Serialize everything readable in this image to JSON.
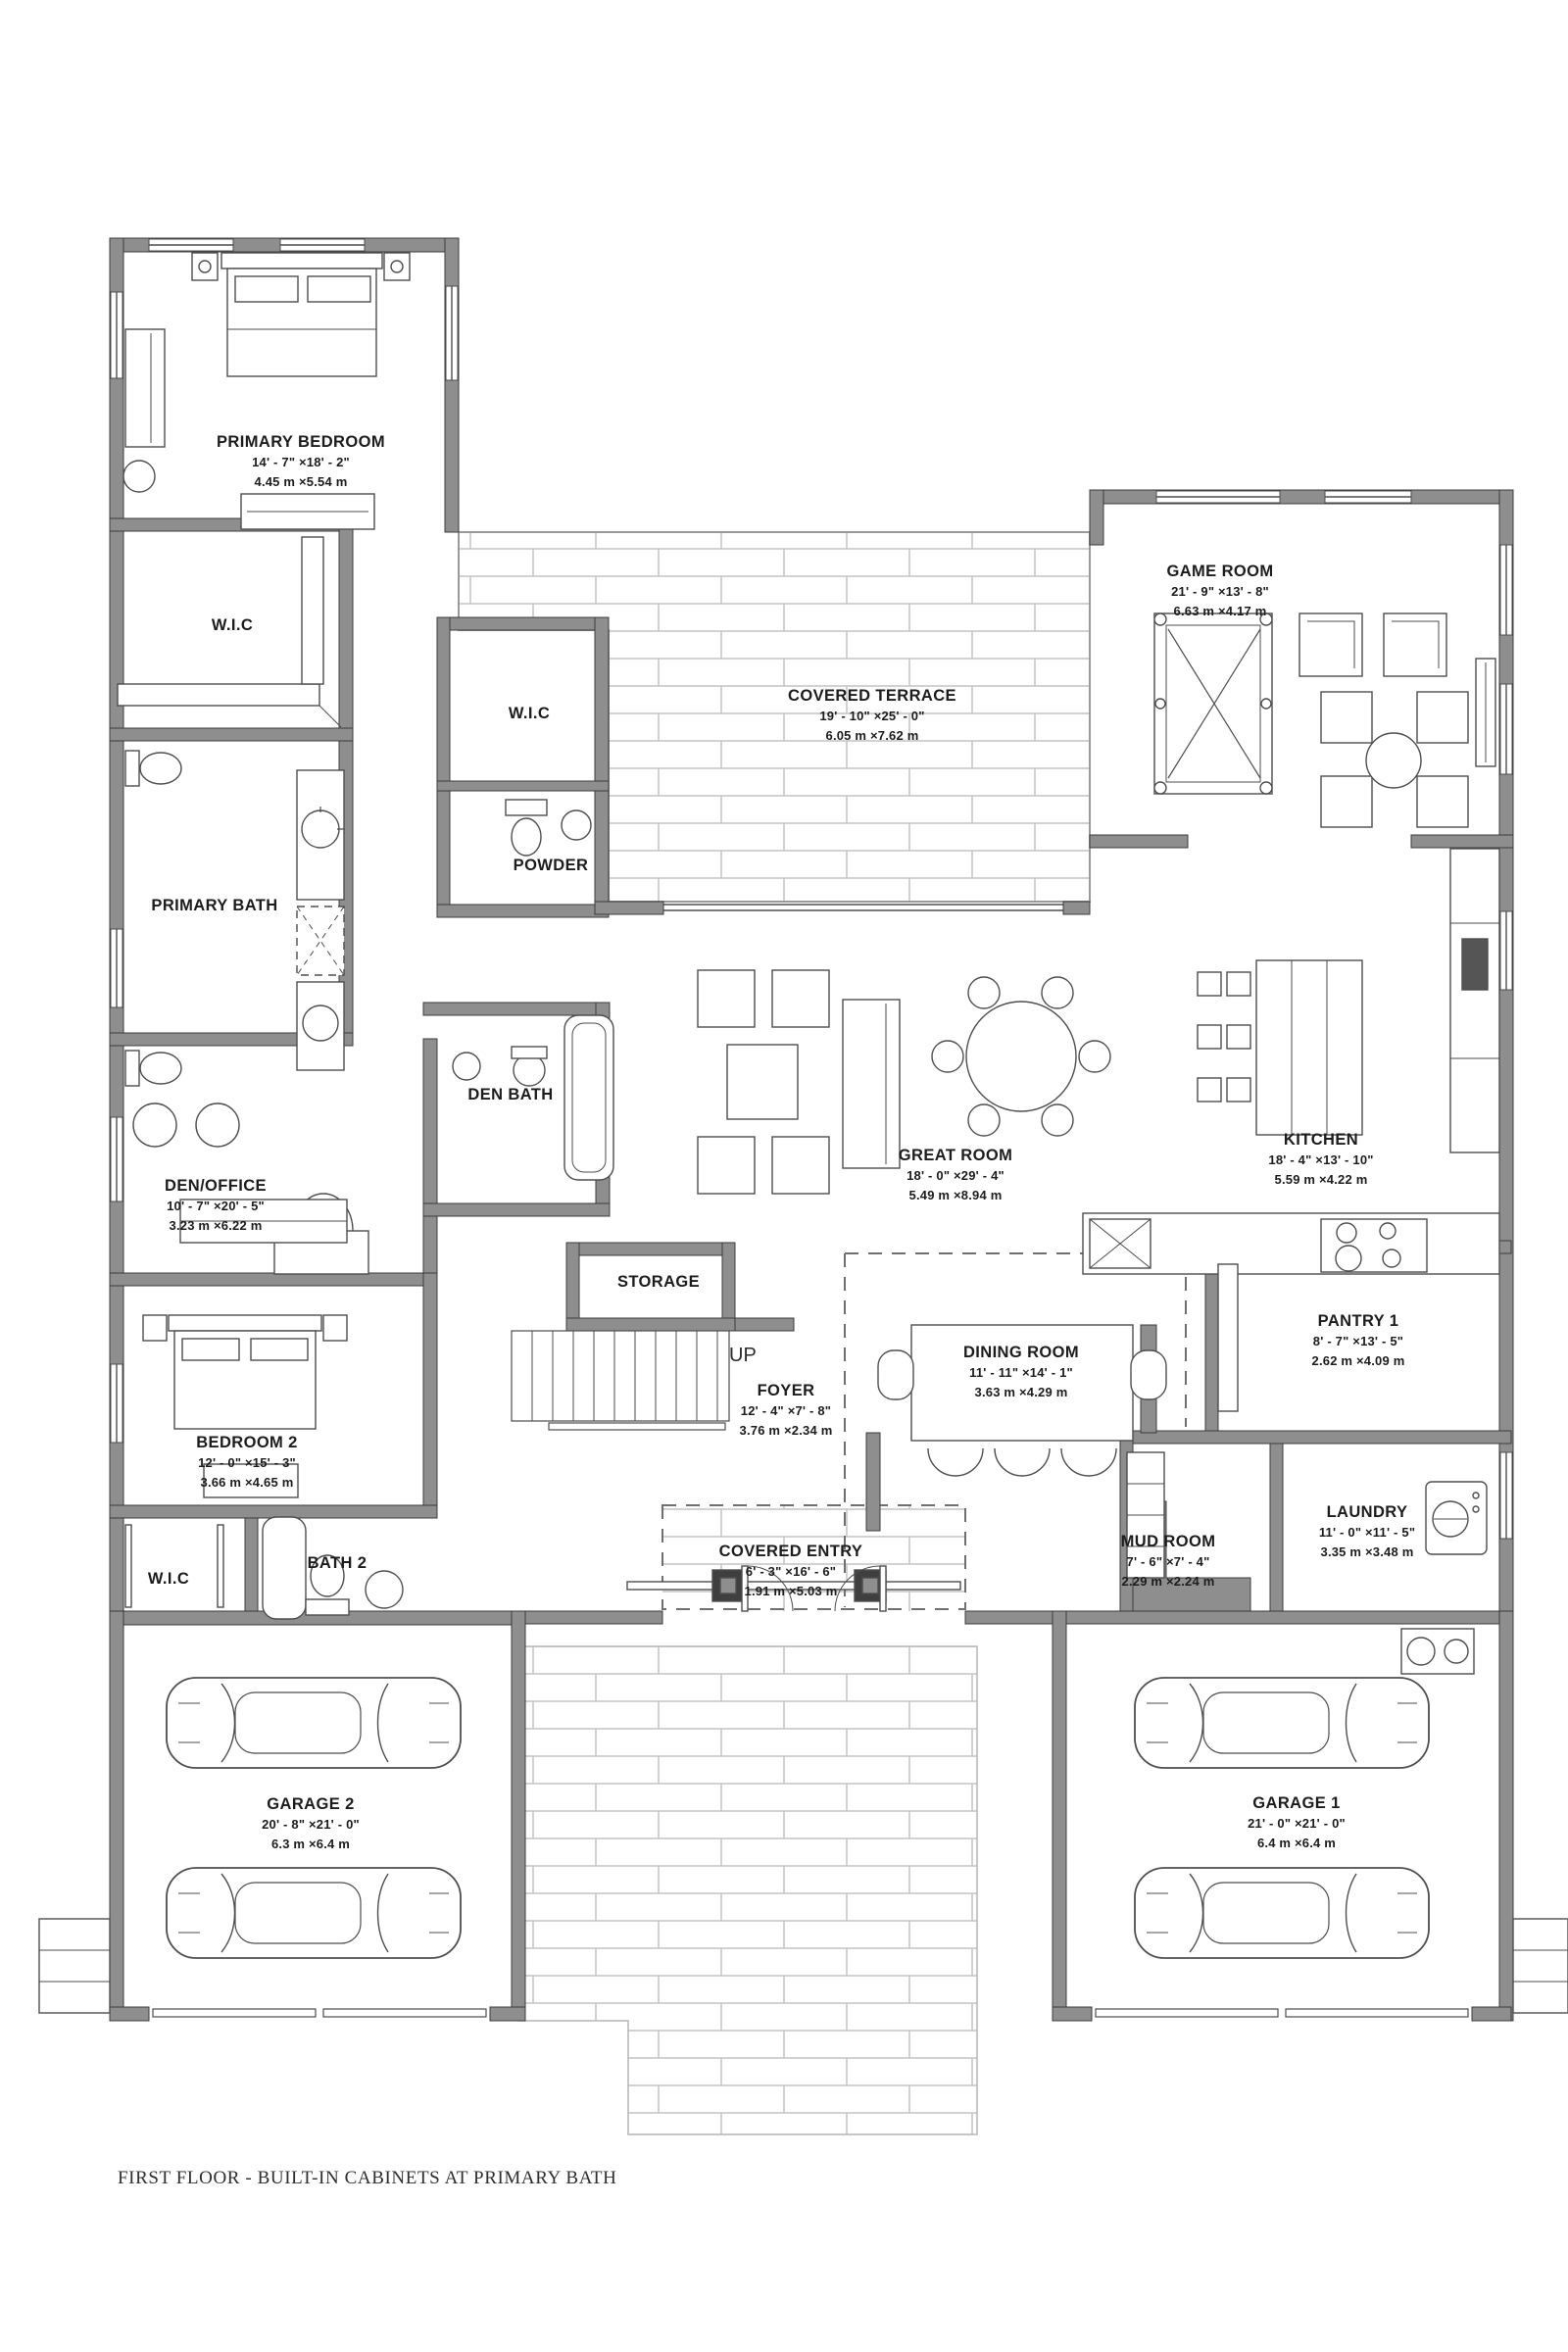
{
  "page": {
    "footer": "FIRST FLOOR - BUILT-IN CABINETS AT PRIMARY BATH"
  },
  "colors": {
    "wall": "#8e8e8e",
    "outline": "#3c3c3c",
    "furniture_line": "#4e4e4e",
    "brick_line": "#c4c4c4",
    "text": "#1c1c1c"
  },
  "stairs": {
    "direction_label": "UP"
  },
  "rooms": [
    {
      "id": "primary-bedroom",
      "name": "PRIMARY BEDROOM",
      "dims_ft": "14' - 7\" ×18' - 2\"",
      "dims_m": "4.45 m ×5.54 m"
    },
    {
      "id": "wic-primary",
      "name": "W.I.C"
    },
    {
      "id": "wic-hall",
      "name": "W.I.C"
    },
    {
      "id": "covered-terrace",
      "name": "COVERED TERRACE",
      "dims_ft": "19' - 10\" ×25' - 0\"",
      "dims_m": "6.05 m ×7.62 m"
    },
    {
      "id": "game-room",
      "name": "GAME ROOM",
      "dims_ft": "21' - 9\" ×13' - 8\"",
      "dims_m": "6.63 m ×4.17 m"
    },
    {
      "id": "powder",
      "name": "POWDER"
    },
    {
      "id": "primary-bath",
      "name": "PRIMARY BATH"
    },
    {
      "id": "den-bath",
      "name": "DEN BATH"
    },
    {
      "id": "great-room",
      "name": "GREAT ROOM",
      "dims_ft": "18' - 0\" ×29' - 4\"",
      "dims_m": "5.49 m ×8.94 m"
    },
    {
      "id": "kitchen",
      "name": "KITCHEN",
      "dims_ft": "18' - 4\" ×13' - 10\"",
      "dims_m": "5.59 m ×4.22 m"
    },
    {
      "id": "den-office",
      "name": "DEN/OFFICE",
      "dims_ft": "10' - 7\" ×20' - 5\"",
      "dims_m": "3.23 m ×6.22 m"
    },
    {
      "id": "storage",
      "name": "STORAGE"
    },
    {
      "id": "foyer",
      "name": "FOYER",
      "dims_ft": "12' - 4\" ×7' - 8\"",
      "dims_m": "3.76 m ×2.34 m"
    },
    {
      "id": "dining-room",
      "name": "DINING ROOM",
      "dims_ft": "11' - 11\" ×14' - 1\"",
      "dims_m": "3.63 m ×4.29 m"
    },
    {
      "id": "pantry-1",
      "name": "PANTRY 1",
      "dims_ft": "8' - 7\" ×13' - 5\"",
      "dims_m": "2.62 m ×4.09 m"
    },
    {
      "id": "bedroom-2",
      "name": "BEDROOM 2",
      "dims_ft": "12' - 0\" ×15' - 3\"",
      "dims_m": "3.66 m ×4.65 m"
    },
    {
      "id": "wic-bedroom2",
      "name": "W.I.C"
    },
    {
      "id": "bath-2",
      "name": "BATH 2"
    },
    {
      "id": "covered-entry",
      "name": "COVERED ENTRY",
      "dims_ft": "6' - 3\" ×16' - 6\"",
      "dims_m": "1.91 m ×5.03 m"
    },
    {
      "id": "mud-room",
      "name": "MUD ROOM",
      "dims_ft": "7' - 6\" ×7' - 4\"",
      "dims_m": "2.29 m ×2.24 m"
    },
    {
      "id": "laundry",
      "name": "LAUNDRY",
      "dims_ft": "11' - 0\" ×11' - 5\"",
      "dims_m": "3.35 m ×3.48 m"
    },
    {
      "id": "garage-2",
      "name": "GARAGE 2",
      "dims_ft": "20' - 8\" ×21' - 0\"",
      "dims_m": "6.3 m ×6.4 m"
    },
    {
      "id": "garage-1",
      "name": "GARAGE 1",
      "dims_ft": "21' - 0\" ×21' - 0\"",
      "dims_m": "6.4 m ×6.4 m"
    }
  ]
}
